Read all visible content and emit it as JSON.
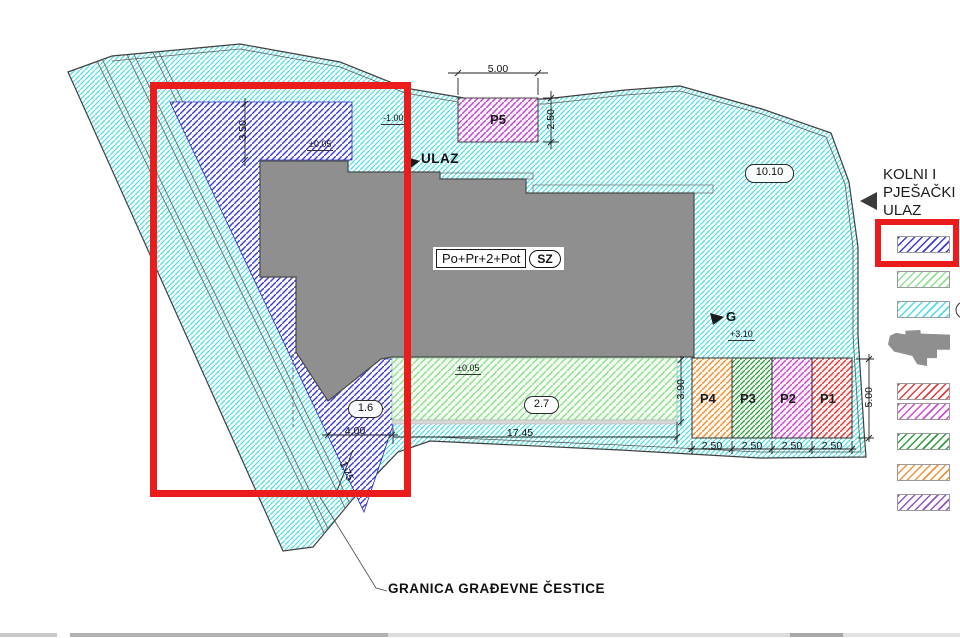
{
  "plan": {
    "building": {
      "label": "Po+Pr+2+Pot",
      "orientation": "SZ"
    },
    "entrance_label": "ULAZ",
    "garage_label": "G",
    "boundary_note": "GRANICA GRAĐEVNE ČESTICE",
    "area_tags": {
      "plot": "10.10",
      "garden": "2.7",
      "path": "1.6"
    },
    "levels": {
      "entrance": "-1.00",
      "plateau": "±0.05",
      "garden": "±0.05",
      "garage": "+3.10"
    },
    "dimensions": {
      "p5_width": "5.00",
      "p5_depth": "2.50",
      "north_setback": "3.50",
      "path_width": "4.00",
      "garden_length": "17.45",
      "garden_depth": "3.90",
      "parking_depth": "5.00",
      "path_tip": "1.75",
      "stall_widths": [
        "2.50",
        "2.50",
        "2.50",
        "2.50"
      ]
    },
    "parking_stalls": [
      {
        "id": "P5",
        "color": "#c04ad0"
      },
      {
        "id": "P4",
        "color": "#f0943c"
      },
      {
        "id": "P3",
        "color": "#2f9e3f"
      },
      {
        "id": "P2",
        "color": "#d24ad2"
      },
      {
        "id": "P1",
        "color": "#e43b3b"
      }
    ]
  },
  "legend": {
    "entrance_note_lines": [
      "KOLNI I",
      "PJEŠAČKI",
      "ULAZ"
    ],
    "swatches": [
      {
        "name": "entrance-access-zone",
        "color": "#3b3bd8",
        "highlighted": true
      },
      {
        "name": "green-area",
        "color": "#8fe08f",
        "highlighted": false
      },
      {
        "name": "plot-surface",
        "color": "#4ddfe4",
        "highlighted": false
      },
      {
        "name": "building-footprint",
        "color": "#8f8f8f",
        "highlighted": false
      },
      {
        "name": "parking-red",
        "color": "#e43b3b",
        "highlighted": false
      },
      {
        "name": "parking-magenta",
        "color": "#d24ad2",
        "highlighted": false
      },
      {
        "name": "parking-green",
        "color": "#2f9e3f",
        "highlighted": false
      },
      {
        "name": "parking-orange",
        "color": "#f0943c",
        "highlighted": false
      },
      {
        "name": "parking-purple",
        "color": "#9353c0",
        "highlighted": false
      }
    ]
  },
  "annotation_color": "#ea1c1c"
}
